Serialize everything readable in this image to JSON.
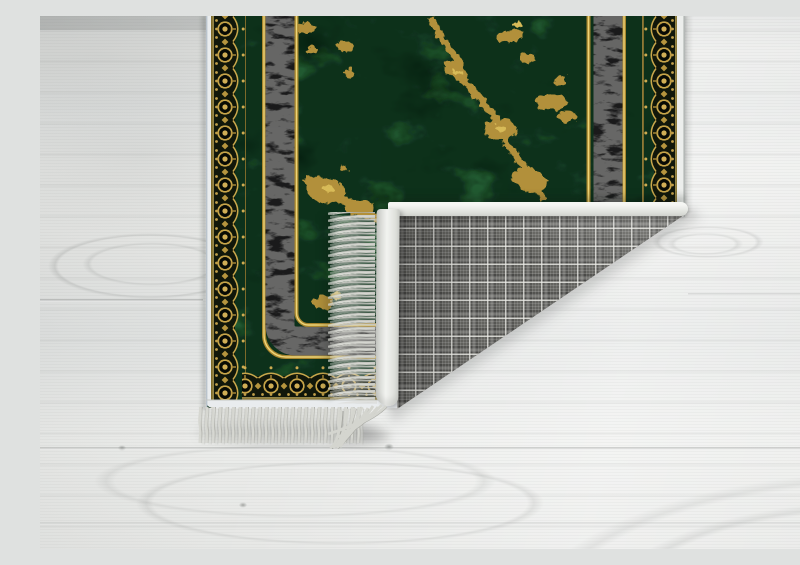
{
  "image": {
    "description": "Product photo of a dark green marble-effect rug with gold veining, a black textured accent stripe framed by thin gold lines and an ornate gold lace border, lying on a whitewashed wood plank floor; the bottom-right corner is folded over to show the gray plaid woven backing, white edge binding and white fringe tassels",
    "subject": "rug",
    "background": "white wood floor"
  },
  "palette": {
    "floor_wood": "#e8e9e7",
    "rug_green_dark": "#123419",
    "rug_green_light": "#2e7a44",
    "gold_vein": "#b2903a",
    "gold_vein_bright": "#d8bb58",
    "gold_border": "#c9a84c",
    "gold_line": "#a8862e",
    "black_stripe": "#1a1a1b",
    "white_binding": "#edefec",
    "fringe_white": "#d6d7d1",
    "plaid_gray": "#63635f",
    "plaid_line": "#eeeee9",
    "shadow": "rgba(0,0,0,0.25)"
  }
}
